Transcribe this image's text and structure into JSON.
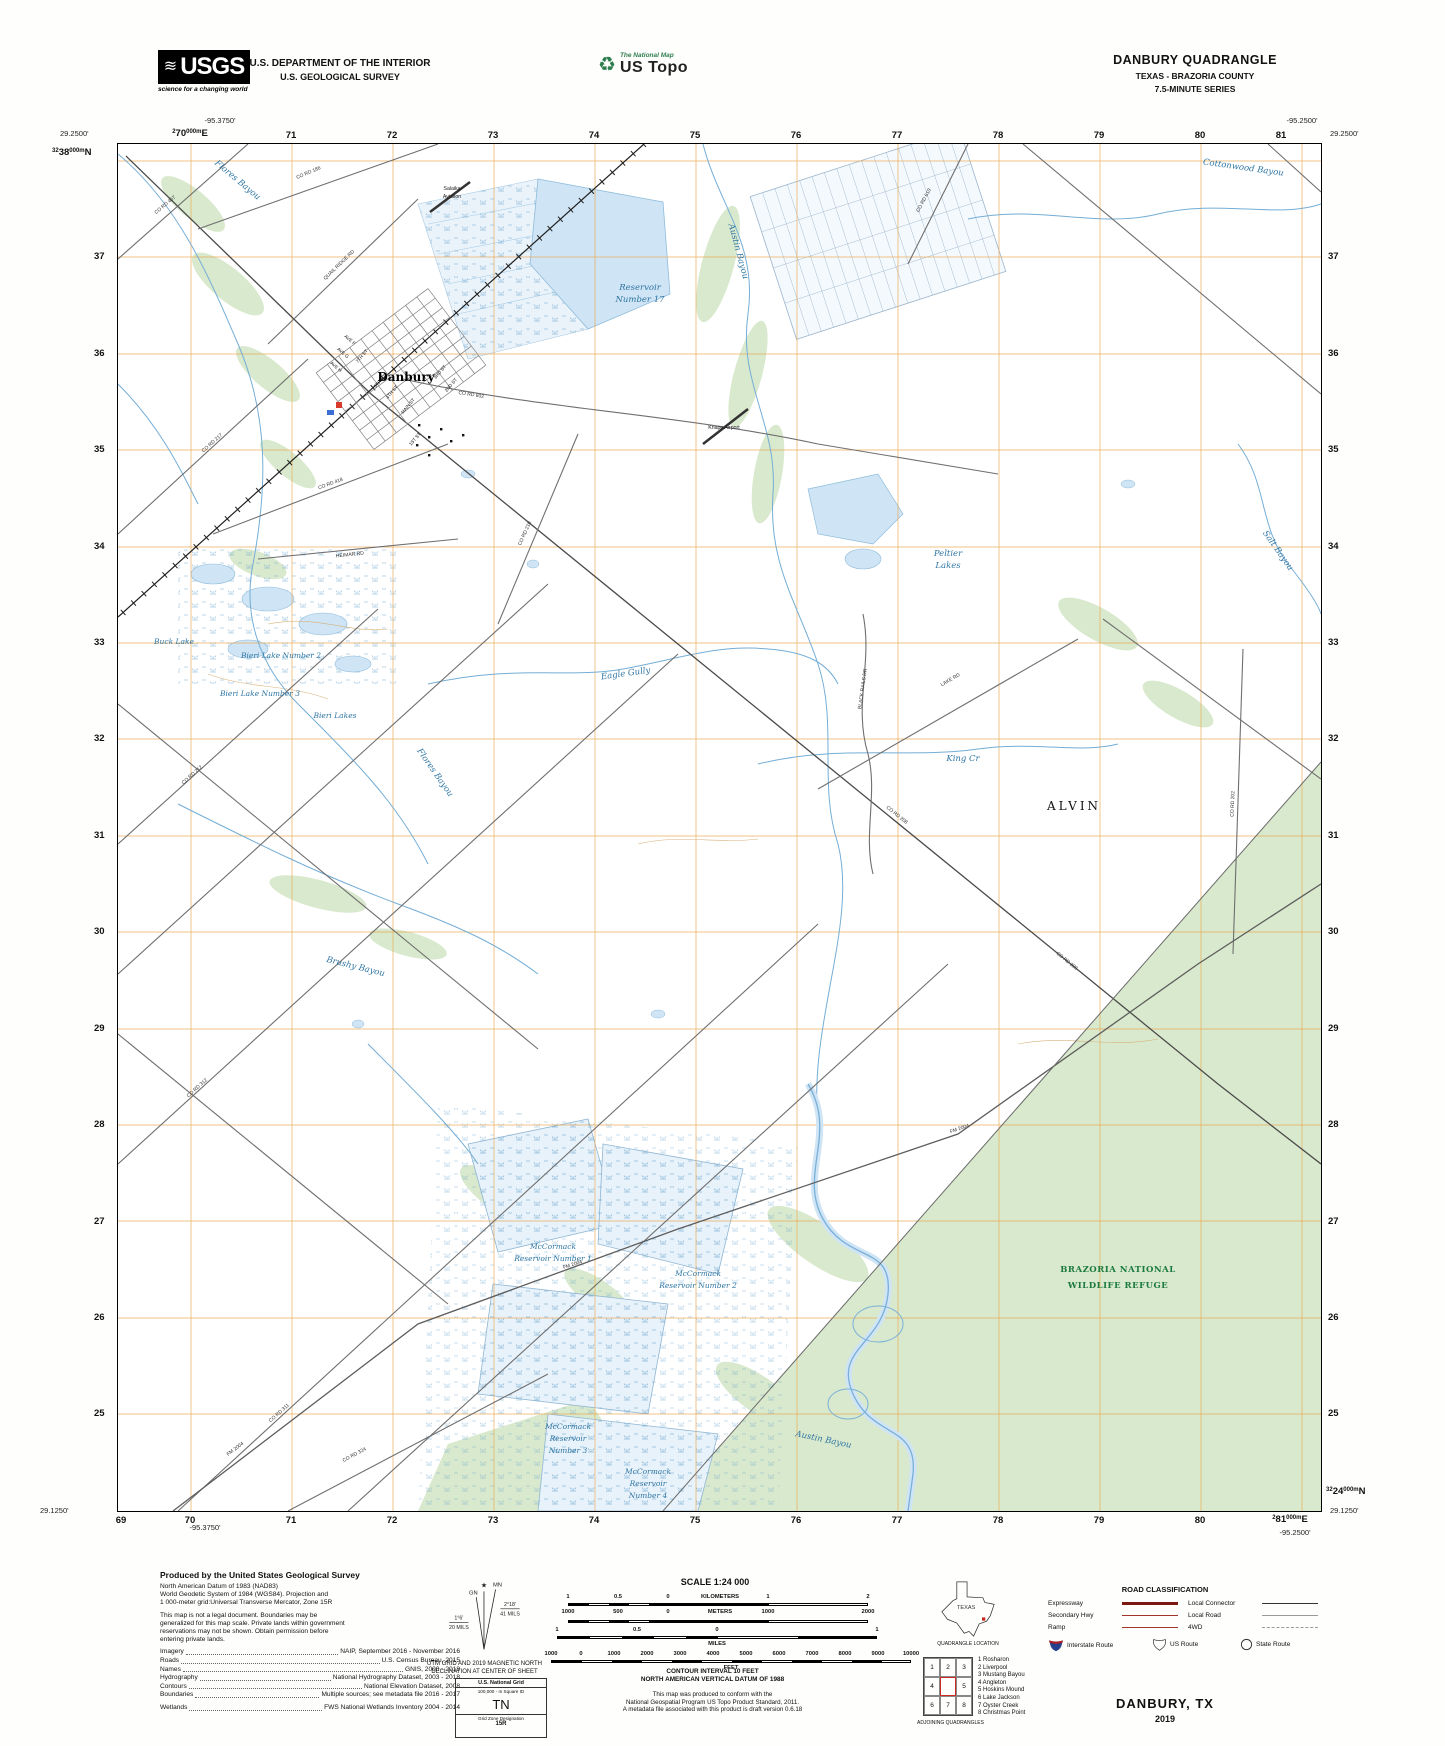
{
  "header": {
    "usgs_logo_text": "USGS",
    "usgs_tagline": "science for a changing world",
    "usgs_wave_icon": "≋",
    "dept_line1": "U.S. DEPARTMENT OF THE INTERIOR",
    "dept_line2": "U.S. GEOLOGICAL SURVEY",
    "ustopo_icon": "♻",
    "ustopo_small": "The National Map",
    "ustopo_big": "US Topo",
    "quad_title": "DANBURY QUADRANGLE",
    "quad_state": "TEXAS - BRAZORIA COUNTY",
    "quad_series": "7.5-MINUTE SERIES"
  },
  "collar": {
    "tl_lon": "-95.3750'",
    "tl_lat": "29.2500'",
    "tr_lon": "-95.2500'",
    "tr_lat": "29.2500'",
    "bl_lat": "29.1250'",
    "bl_lon": "-95.3750'",
    "br_lat": "29.1250'",
    "br_lon": "-95.2500'",
    "first_easting": {
      "pre": "2",
      "big": "70",
      "sup": "000m",
      "dir": "E"
    },
    "first_northing": {
      "pre": "32",
      "big": "38",
      "sup": "000m",
      "dir": "N"
    },
    "last_northing": {
      "pre": "32",
      "big": "24",
      "sup": "000m",
      "dir": "N"
    },
    "last_easting": {
      "pre": "2",
      "big": "81",
      "sup": "000m",
      "dir": "E"
    },
    "top": [
      "71",
      "72",
      "73",
      "74",
      "75",
      "76",
      "77",
      "78",
      "79",
      "80",
      "81"
    ],
    "bottom": [
      "69",
      "70",
      "71",
      "72",
      "73",
      "74",
      "75",
      "76",
      "77",
      "78",
      "79",
      "80"
    ],
    "left": [
      "37",
      "36",
      "35",
      "34",
      "33",
      "32",
      "31",
      "30",
      "29",
      "28",
      "27",
      "26",
      "25"
    ],
    "right": [
      "37",
      "36",
      "35",
      "34",
      "33",
      "32",
      "31",
      "30",
      "29",
      "28",
      "27",
      "26",
      "25"
    ]
  },
  "map": {
    "town": "Danbury",
    "city": "ALVIN",
    "refuge1": "BRAZORIA NATIONAL",
    "refuge2": "WILDLIFE REFUGE",
    "salaika1": "Salaika",
    "salaika2": "Aviation",
    "knape": "Knape Airport",
    "water": {
      "res17a": "Reservoir",
      "res17b": "Number 17",
      "cottonwood": "Cottonwood Bayou",
      "flores": "Flores Bayou",
      "flores2": "Flores Bayou",
      "austin": "Austin Bayou",
      "austin2": "Austin Bayou",
      "salt": "Salt Bayou",
      "eagle": "Eagle Gully",
      "king": "King Cr",
      "brushy": "Brushy Bayou",
      "peltier1": "Peltier",
      "peltier2": "Lakes",
      "buck": "Buck Lake",
      "bieri2": "Bieri Lake Number 2",
      "bieri3": "Bieri Lake Number 3",
      "bieri": "Bieri Lakes",
      "mc1a": "McCormack",
      "mc1b": "Reservoir Number 1",
      "mc2a": "McCormack",
      "mc2b": "Reservoir Number 2",
      "mc3a": "McCormack",
      "mc3b": "Reservoir",
      "mc3c": "Number 3",
      "mc4a": "McCormack",
      "mc4b": "Reservoir",
      "mc4c": "Number 4"
    },
    "roads": {
      "r457": "CO RD 457",
      "r186": "CO RD 186",
      "quail": "QUAIL RIDGE RD",
      "r602": "CO RD 602",
      "r418": "CO RD 418",
      "r217": "CO RD 217",
      "r210": "CO RD 210",
      "heimar": "HEIMAR RD",
      "r208": "CO RD 208",
      "r208b": "CO RD 208",
      "r212": "CO RD 212",
      "r312": "CO RD 312",
      "r311": "CO RD 311",
      "fm2004": "FM 2004",
      "fm2004b": "FM 2004",
      "fm2004c": "FM 2004",
      "r324": "CO RD 324",
      "lake": "LAKE RD",
      "blackrails": "BLACK RAILS DR",
      "r202": "CO RD 202",
      "r610": "CO RD 610"
    },
    "streets": [
      "AVE F",
      "AVE G",
      "AVE H",
      "7TH ST",
      "5TH ST",
      "4TH ST",
      "MAIN ST",
      "3RD ST",
      "2ND ST",
      "1ST ST"
    ]
  },
  "footer": {
    "produced": {
      "title": "Produced by the United States Geological Survey",
      "datum_lines": [
        "North American Datum of 1983 (NAD83)",
        "World Geodetic System of 1984 (WGS84).  Projection and",
        "1 000-meter grid:Universal Transverse Mercator, Zone 15R"
      ],
      "legal_lines": [
        "This map is not a legal document. Boundaries may be",
        "generalized for this map scale. Private lands within government",
        "reservations may not be shown. Obtain permission before",
        "entering private lands."
      ],
      "sources": [
        {
          "label": "Imagery",
          "value": "NAIP, September 2016 - November 2016"
        },
        {
          "label": "Roads",
          "value": "U.S. Census Bureau, 2015"
        },
        {
          "label": "Names",
          "value": "GNIS, 2000 - 2018"
        },
        {
          "label": "Hydrography",
          "value": "National Hydrography Dataset, 2003 - 2018"
        },
        {
          "label": "Contours",
          "value": "National Elevation Dataset, 2008"
        },
        {
          "label": "Boundaries",
          "value": "Multiple sources; see metadata file 2016 - 2017"
        },
        {
          "label": "Wetlands",
          "value": "FWS National Wetlands Inventory 2004 - 2014"
        }
      ]
    },
    "declination": {
      "star_icon": "★",
      "mn": "MN",
      "gn": "GN",
      "gn_deg": "1°6'",
      "gn_mils": "20 MILS",
      "mn_deg": "2°18'",
      "mn_mils": "41 MILS",
      "caption1": "UTM GRID AND 2019 MAGNETIC NORTH",
      "caption2": "DECLINATION AT CENTER OF SHEET"
    },
    "usng": {
      "title": "U.S. National Grid",
      "sub": "100,000 - m Square ID",
      "square": "TN",
      "zone_label": "Grid Zone Designation",
      "zone": "15R"
    },
    "scale": {
      "title": "SCALE 1:24 000",
      "km_row": [
        "1",
        "0.5",
        "0",
        "KILOMETERS",
        "1",
        "2"
      ],
      "m_row": [
        "1000",
        "500",
        "0",
        "METERS",
        "1000",
        "2000"
      ],
      "mi_row": [
        "1",
        "0.5",
        "0",
        "1"
      ],
      "mi_label": "MILES",
      "ft_row": [
        "1000",
        "0",
        "1000",
        "2000",
        "3000",
        "4000",
        "5000",
        "6000",
        "7000",
        "8000",
        "9000",
        "10000"
      ],
      "ft_label": "FEET",
      "contour1": "CONTOUR INTERVAL 10 FEET",
      "contour2": "NORTH AMERICAN VERTICAL DATUM OF 1988",
      "conform": [
        "This map was produced to conform with the",
        "National Geospatial Program US Topo Product Standard, 2011.",
        "A metadata file associated with this product is draft version 0.6.18"
      ]
    },
    "location": {
      "state": "TEXAS",
      "caption": "QUADRANGLE LOCATION"
    },
    "adjoining": {
      "cells": [
        "1",
        "2",
        "3",
        "4",
        "5",
        "6",
        "7",
        "8"
      ],
      "caption": "ADJOINING QUADRANGLES",
      "names": [
        "1 Rosharon",
        "2 Liverpool",
        "3 Mustang Bayou",
        "4 Angleton",
        "5 Hoskins Mound",
        "6 Lake Jackson",
        "7 Oyster Creek",
        "8 Christmas Point"
      ]
    },
    "roadclass": {
      "title": "ROAD CLASSIFICATION",
      "rows_left": [
        "Expressway",
        "Secondary Hwy",
        "Ramp"
      ],
      "rows_right": [
        "Local Connector",
        "Local Road",
        "4WD"
      ],
      "shields": [
        "Interstate Route",
        "US Route",
        "State Route"
      ]
    },
    "sheet": {
      "title": "DANBURY,  TX",
      "year": "2019"
    }
  }
}
